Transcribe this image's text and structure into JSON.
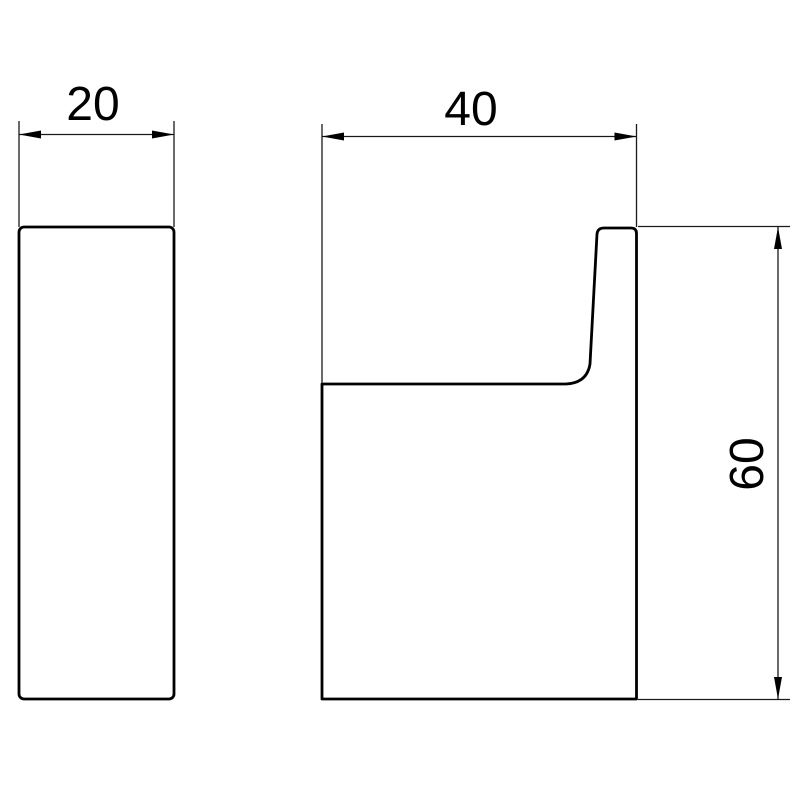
{
  "drawing": {
    "kind": "technical-dimension-drawing",
    "subject": "wall-hook-two-views",
    "colors": {
      "background": "#ffffff",
      "outline": "#000000",
      "dimension_lines": "#1a1a1a"
    },
    "views": {
      "side": {
        "name": "side-profile-view"
      },
      "front": {
        "name": "front-hook-view"
      }
    },
    "dimensions": {
      "side_width": {
        "label": "20",
        "orientation": "horizontal"
      },
      "front_width": {
        "label": "40",
        "orientation": "horizontal"
      },
      "front_height": {
        "label": "60",
        "orientation": "vertical"
      }
    }
  }
}
